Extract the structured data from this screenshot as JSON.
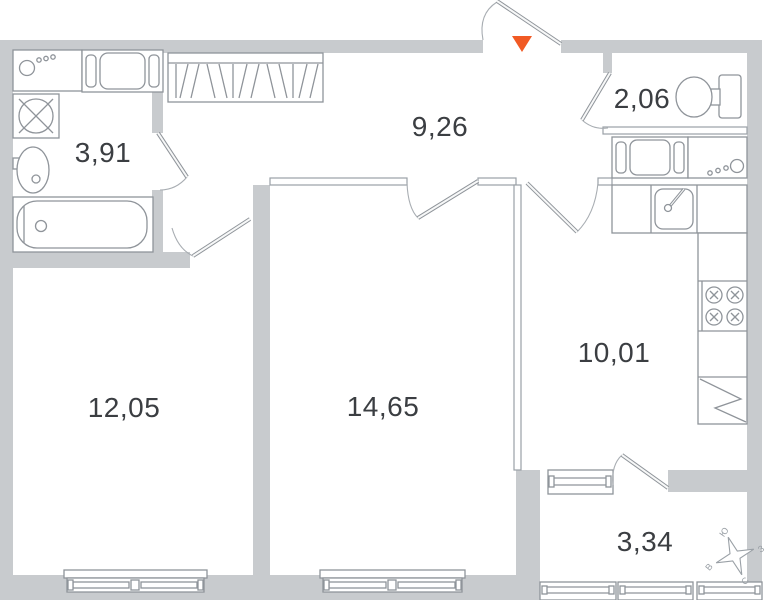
{
  "rooms": [
    {
      "id": "bathroom",
      "area": "3,91"
    },
    {
      "id": "hallway",
      "area": "9,26"
    },
    {
      "id": "wc",
      "area": "2,06"
    },
    {
      "id": "room-1",
      "area": "12,05"
    },
    {
      "id": "room-2",
      "area": "14,65"
    },
    {
      "id": "kitchen",
      "area": "10,01"
    },
    {
      "id": "balcony",
      "area": "3,34"
    }
  ],
  "compass": {
    "south": "Ю",
    "west": "З",
    "north": "С",
    "east": "В"
  },
  "colors": {
    "wall": "#c8cbce",
    "fixture_outline": "#8f949a",
    "accent": "#f15a24",
    "label_text": "#3b3e42",
    "compass_text": "#9aa0a6"
  }
}
